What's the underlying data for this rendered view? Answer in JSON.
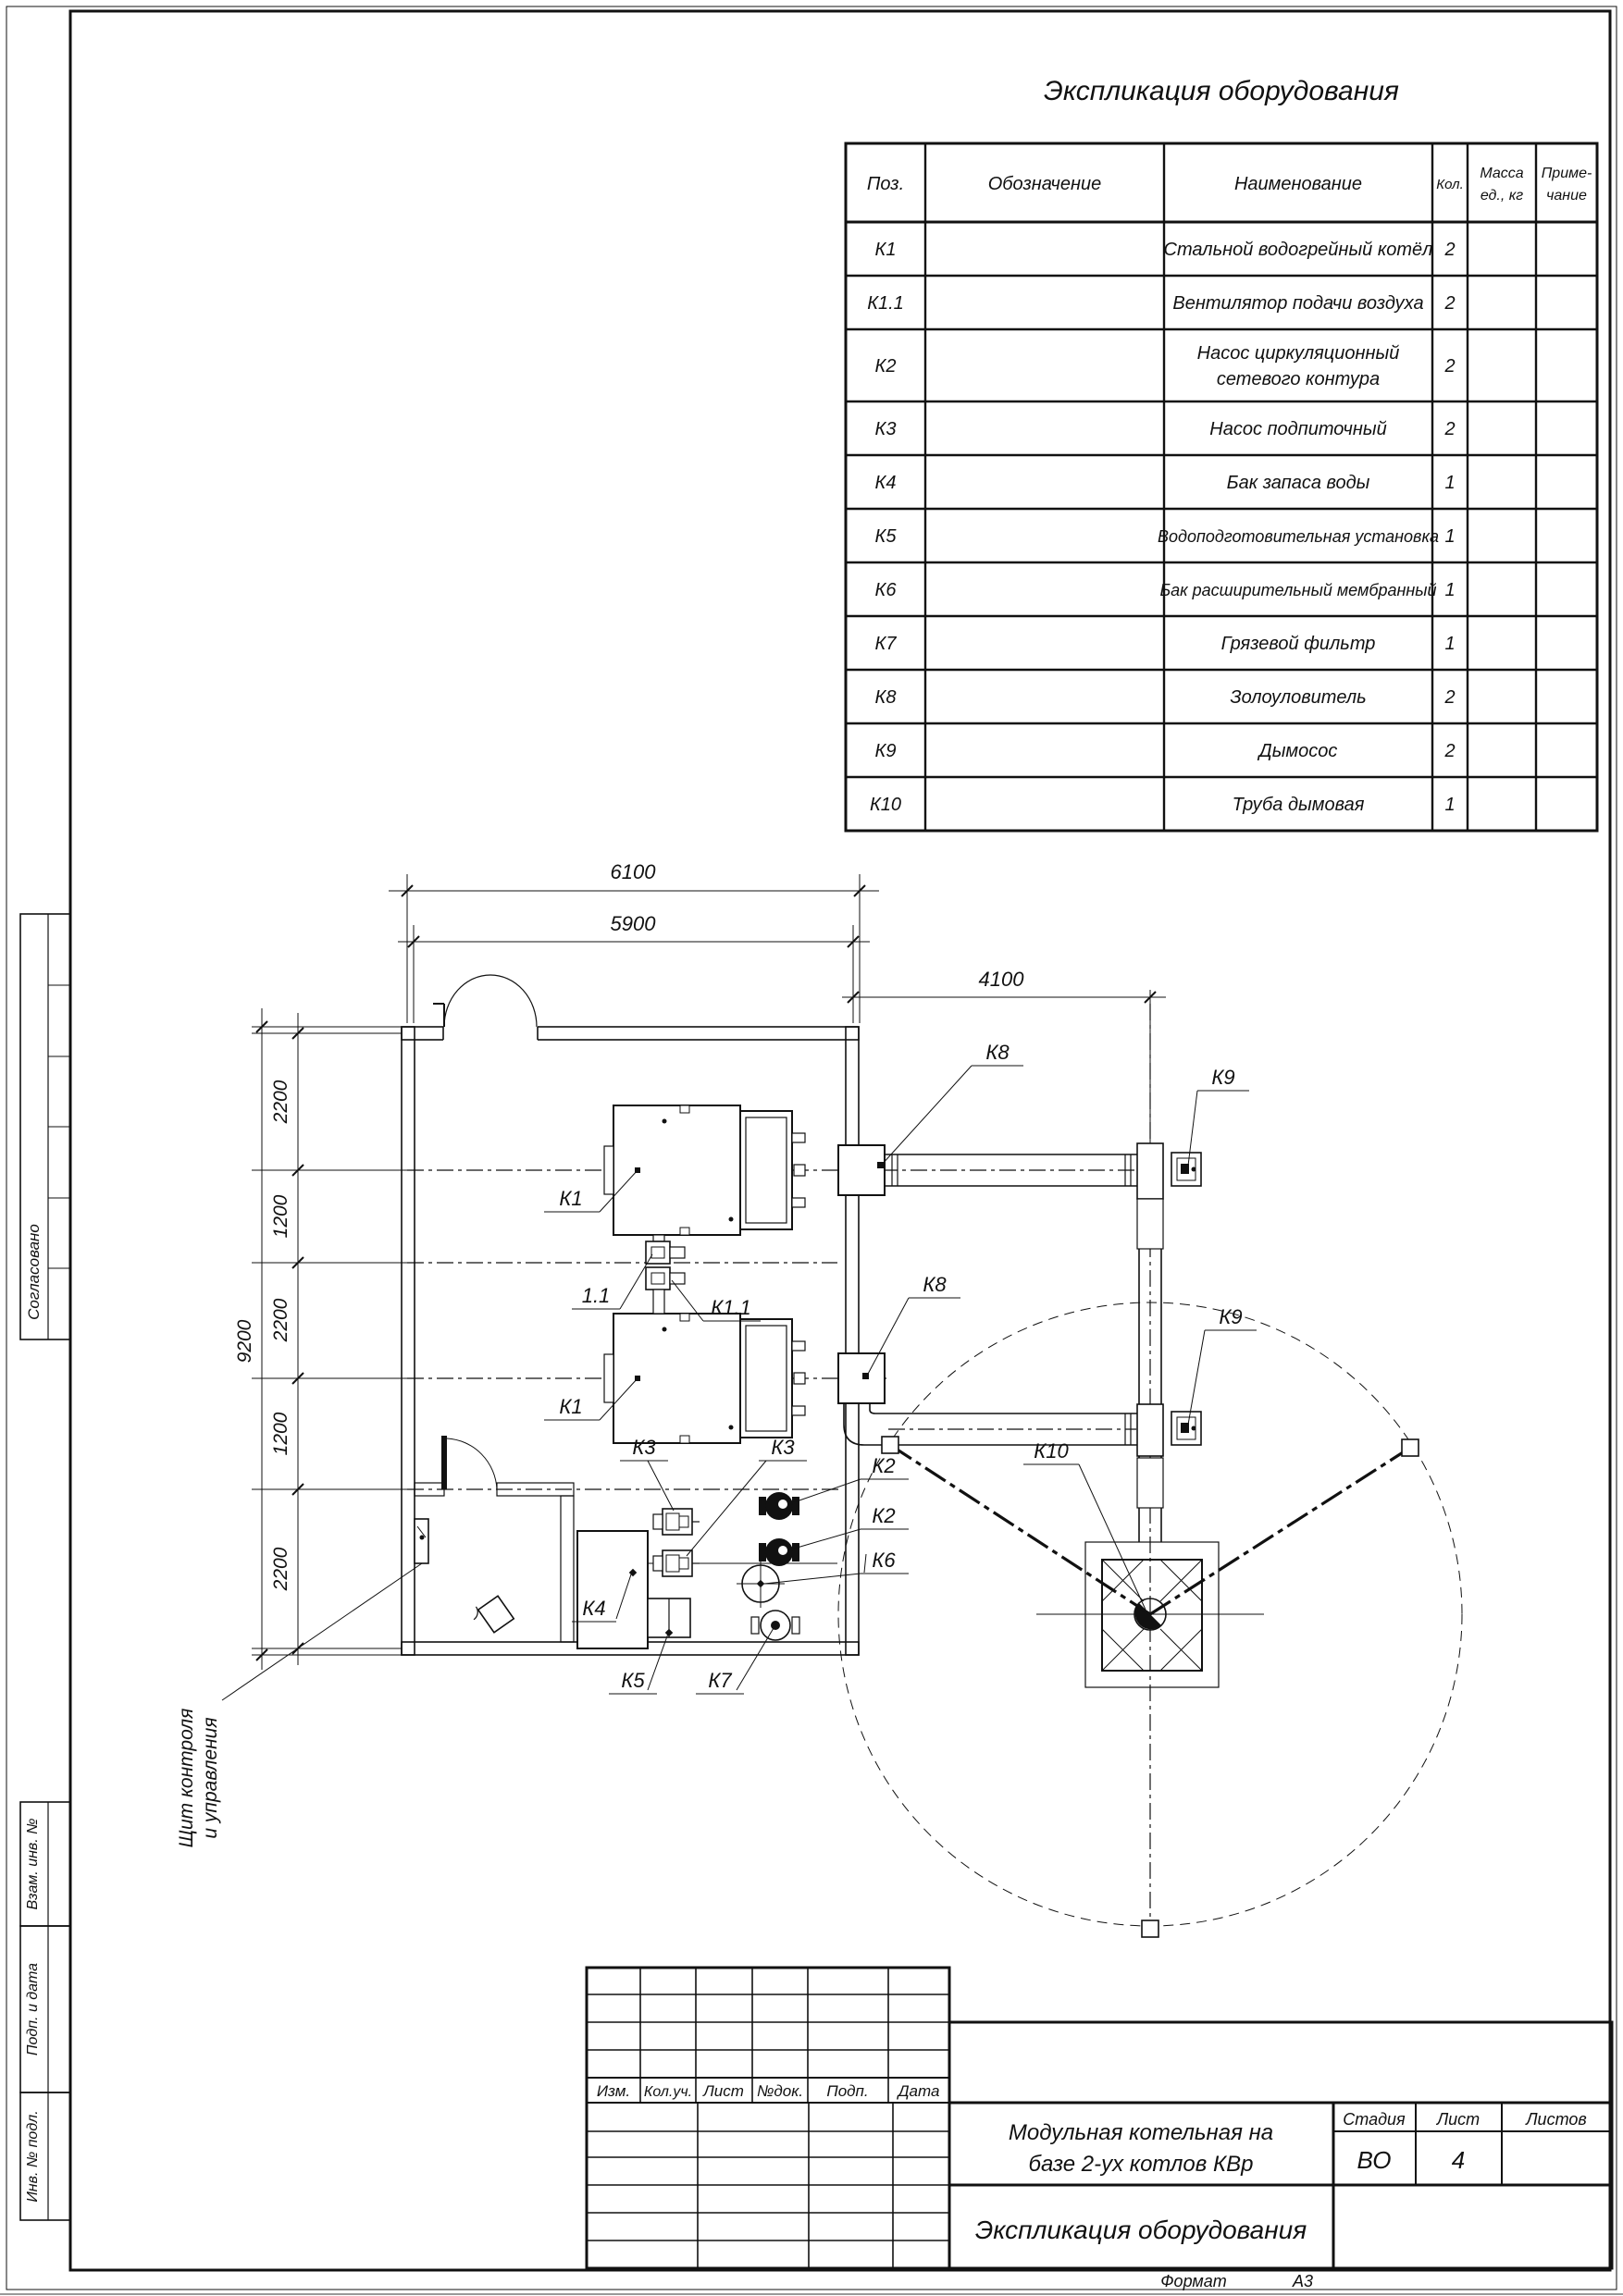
{
  "colors": {
    "line": "#111111",
    "paper": "#ffffff"
  },
  "equipment_table": {
    "title": "Экспликация оборудования",
    "headers": {
      "pos": "Поз.",
      "designation": "Обозначение",
      "name": "Наименование",
      "qty": "Кол.",
      "mass_l1": "Масса",
      "mass_l2": "ед., кг",
      "note_l1": "Приме-",
      "note_l2": "чание"
    },
    "rows": [
      {
        "pos": "К1",
        "name": "Стальной водогрейный котёл",
        "qty": "2"
      },
      {
        "pos": "К1.1",
        "name": "Вентилятор подачи воздуха",
        "qty": "2"
      },
      {
        "pos": "К2",
        "name": "Насос циркуляционный",
        "name2": "сетевого контура",
        "qty": "2"
      },
      {
        "pos": "К3",
        "name": "Насос подпиточный",
        "qty": "2"
      },
      {
        "pos": "К4",
        "name": "Бак запаса воды",
        "qty": "1"
      },
      {
        "pos": "К5",
        "name": "Водоподготовительная установка",
        "qty": "1"
      },
      {
        "pos": "К6",
        "name": "Бак расширительный мембранный",
        "qty": "1"
      },
      {
        "pos": "К7",
        "name": "Грязевой фильтр",
        "qty": "1"
      },
      {
        "pos": "К8",
        "name": "Золоуловитель",
        "qty": "2"
      },
      {
        "pos": "К9",
        "name": "Дымосос",
        "qty": "2"
      },
      {
        "pos": "К10",
        "name": "Труба дымовая",
        "qty": "1"
      }
    ]
  },
  "plan": {
    "dims": {
      "overall_width": "6100",
      "inner_width": "5900",
      "flue_offset": "4100",
      "overall_height": "9200",
      "row1": "2200",
      "row2": "1200",
      "row3": "2200",
      "row4": "1200",
      "row5": "2200"
    },
    "tags": {
      "k1": "К1",
      "k11": "К1.1",
      "fan": "1.1",
      "k2": "К2",
      "k3": "К3",
      "k4": "К4",
      "k5": "К5",
      "k6": "К6",
      "k7": "К7",
      "k8": "К8",
      "k9": "К9",
      "k10": "К10"
    },
    "control_panel_l1": "Щит контроля",
    "control_panel_l2": "и управления"
  },
  "stamps": {
    "approved": "Согласовано",
    "replace_inv": "Взам. инв. №",
    "sign_date": "Подп. и дата",
    "inv_orig": "Инв. № подл."
  },
  "title_block": {
    "revision_headers": [
      "Изм.",
      "Кол.уч.",
      "Лист",
      "№док.",
      "Подп.",
      "Дата"
    ],
    "project_l1": "Модульная котельная на",
    "project_l2": "базе 2-ух котлов КВр",
    "doc_title": "Экспликация оборудования",
    "stage_label": "Стадия",
    "sheet_label": "Лист",
    "sheets_label": "Листов",
    "stage_value": "ВО",
    "sheet_value": "4",
    "sheets_value": "",
    "format_label": "Формат",
    "format_value": "А3"
  }
}
